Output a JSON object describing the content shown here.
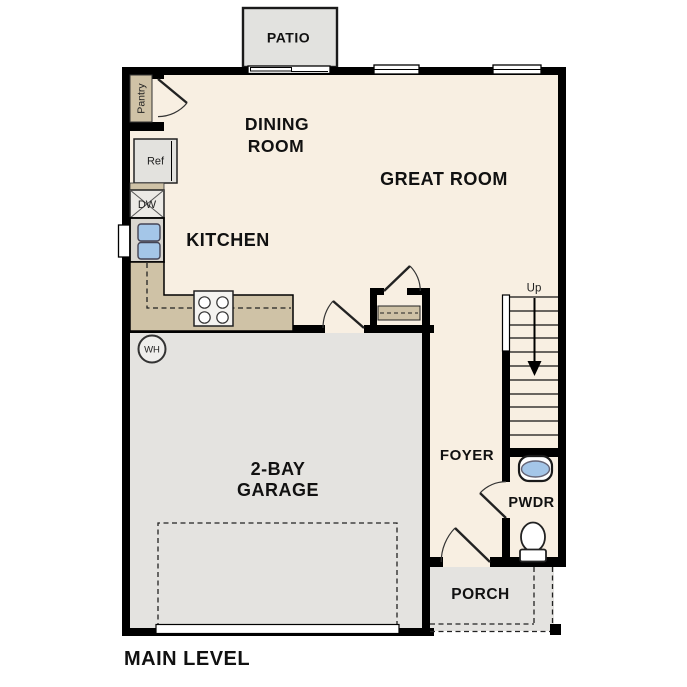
{
  "colors": {
    "wall": "#000000",
    "floor": "#f8efe2",
    "garage_floor": "#e4e3e0",
    "patio_floor": "#e2e2df",
    "porch_floor": "#e4e3e0",
    "counter": "#cfc2a6",
    "sink_blue": "#a4c6e8",
    "appliance_gray": "#e3e2de",
    "dishwasher_gray": "#eceae6",
    "sink_cabinet_gray": "#d9d6d0",
    "stove_white": "#f4f3f0"
  },
  "floor_plan": {
    "title": "MAIN LEVEL",
    "rooms": {
      "patio": {
        "label": "PATIO"
      },
      "dining_room": {
        "line1": "DINING",
        "line2": "ROOM"
      },
      "great_room": {
        "label": "GREAT ROOM"
      },
      "kitchen": {
        "label": "KITCHEN"
      },
      "pantry": {
        "label": "Pantry"
      },
      "garage": {
        "line1": "2-BAY",
        "line2": "GARAGE"
      },
      "foyer": {
        "label": "FOYER"
      },
      "powder_room": {
        "label": "PWDR"
      },
      "porch": {
        "label": "PORCH"
      }
    },
    "fixtures": {
      "refrigerator": {
        "label": "Ref"
      },
      "dishwasher": {
        "label": "DW"
      },
      "water_heater": {
        "label": "WH"
      },
      "stairs": {
        "direction_label": "Up"
      }
    }
  }
}
